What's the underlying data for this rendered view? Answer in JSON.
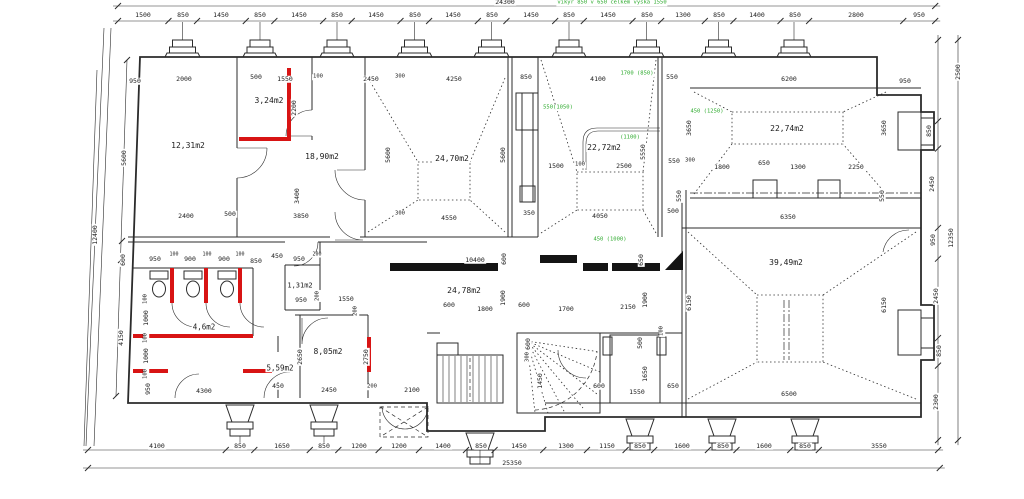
{
  "drawing_type": "floor plan",
  "colors": {
    "line": "#2b2b2b",
    "red": "#d81414",
    "green": "#2daa2d",
    "background": "#ffffff",
    "step_gray": "#c8c8c8"
  },
  "chains": [
    {
      "name": "top-total",
      "dir": "h",
      "x0": 118,
      "y": 6,
      "s": 0.03363,
      "vals": [
        24300
      ]
    },
    {
      "name": "top-detail",
      "dir": "h",
      "x0": 118,
      "y": 21,
      "s": 0.03363,
      "vals": [
        1500,
        850,
        1450,
        850,
        1450,
        850,
        1450,
        850,
        1450,
        850,
        1450,
        850,
        1450,
        850,
        1300,
        850,
        1400,
        850,
        2800,
        950
      ]
    },
    {
      "name": "bottom-detail",
      "dir": "h",
      "x0": 88,
      "y": 450,
      "s": 0.0336,
      "vals": [
        4100,
        850,
        1650,
        850,
        1200,
        1200,
        1400,
        850,
        1450,
        1300,
        1150,
        850,
        1600,
        850,
        1600,
        850,
        3550
      ]
    },
    {
      "name": "bottom-total",
      "dir": "h",
      "x0": 88,
      "y": 468,
      "s": 0.0336,
      "vals": [
        25350
      ]
    },
    {
      "name": "right-detail",
      "dir": "v",
      "x": 938,
      "y0": 40,
      "s": 0.0324,
      "vals": [
        2500,
        850,
        2450,
        950,
        2450,
        850,
        2300
      ]
    },
    {
      "name": "right-total",
      "dir": "v",
      "x": 958,
      "y0": 40,
      "s": 0.0324,
      "vals": [
        12350
      ]
    }
  ],
  "dormers": {
    "top_base": 57,
    "top": [
      [
        168,
        197
      ],
      [
        246,
        274
      ],
      [
        323,
        351
      ],
      [
        400,
        429
      ],
      [
        477,
        506
      ],
      [
        555,
        583
      ],
      [
        632,
        661
      ],
      [
        704,
        733
      ],
      [
        780,
        808
      ]
    ],
    "bottom": [
      [
        226,
        254
      ],
      [
        310,
        338
      ],
      [
        466,
        494
      ],
      [
        626,
        654
      ],
      [
        708,
        736
      ],
      [
        791,
        819
      ]
    ],
    "red_bottom_index": 0
  },
  "rooms": [
    {
      "area": "12,31m2"
    },
    {
      "area": "3,24m2"
    },
    {
      "area": "18,90m2"
    },
    {
      "area": "24,70m2"
    },
    {
      "area": "22,72m2"
    },
    {
      "area": "22,74m2"
    },
    {
      "area": "39,49m2"
    },
    {
      "area": "24,78m2"
    },
    {
      "area": "4,6m2"
    },
    {
      "area": "5,59m2"
    },
    {
      "area": "1,31m2"
    },
    {
      "area": "8,05m2"
    }
  ],
  "labels": [
    {
      "t": "24300",
      "x": 505,
      "y": 2
    },
    {
      "t": "vikyr 850 v 650 celkem vyska 1550",
      "x": 612,
      "y": 3,
      "c": "g",
      "s": 5.5
    },
    {
      "t": "1500",
      "x": 143,
      "y": 15
    },
    {
      "t": "850",
      "x": 183,
      "y": 15
    },
    {
      "t": "1450",
      "x": 221,
      "y": 15
    },
    {
      "t": "850",
      "x": 260,
      "y": 15
    },
    {
      "t": "1450",
      "x": 299,
      "y": 15
    },
    {
      "t": "850",
      "x": 337,
      "y": 15
    },
    {
      "t": "1450",
      "x": 376,
      "y": 15
    },
    {
      "t": "850",
      "x": 415,
      "y": 15
    },
    {
      "t": "1450",
      "x": 453,
      "y": 15
    },
    {
      "t": "850",
      "x": 492,
      "y": 15
    },
    {
      "t": "1450",
      "x": 531,
      "y": 15
    },
    {
      "t": "850",
      "x": 569,
      "y": 15
    },
    {
      "t": "1450",
      "x": 608,
      "y": 15
    },
    {
      "t": "850",
      "x": 647,
      "y": 15
    },
    {
      "t": "1300",
      "x": 683,
      "y": 15
    },
    {
      "t": "850",
      "x": 719,
      "y": 15
    },
    {
      "t": "1400",
      "x": 757,
      "y": 15
    },
    {
      "t": "850",
      "x": 795,
      "y": 15
    },
    {
      "t": "2800",
      "x": 856,
      "y": 15
    },
    {
      "t": "950",
      "x": 919,
      "y": 15
    },
    {
      "t": "950",
      "x": 135,
      "y": 81
    },
    {
      "t": "2000",
      "x": 184,
      "y": 79
    },
    {
      "t": "500",
      "x": 256,
      "y": 77
    },
    {
      "t": "1550",
      "x": 285,
      "y": 79
    },
    {
      "t": "100",
      "x": 318,
      "y": 77,
      "s": 5.5
    },
    {
      "t": "2450",
      "x": 371,
      "y": 79
    },
    {
      "t": "300",
      "x": 400,
      "y": 77,
      "s": 5.5
    },
    {
      "t": "4250",
      "x": 454,
      "y": 79
    },
    {
      "t": "850",
      "x": 526,
      "y": 77
    },
    {
      "t": "4100",
      "x": 598,
      "y": 79
    },
    {
      "t": "1700 (850)",
      "x": 637,
      "y": 74,
      "c": "g",
      "s": 5.5
    },
    {
      "t": "550",
      "x": 672,
      "y": 77
    },
    {
      "t": "6200",
      "x": 789,
      "y": 79
    },
    {
      "t": "950",
      "x": 905,
      "y": 81
    },
    {
      "t": "12,31m2",
      "x": 188,
      "y": 146,
      "s": 8
    },
    {
      "t": "3,24m2",
      "x": 269,
      "y": 101,
      "s": 8
    },
    {
      "t": "18,90m2",
      "x": 322,
      "y": 157,
      "s": 8
    },
    {
      "t": "24,70m2",
      "x": 452,
      "y": 159,
      "s": 8
    },
    {
      "t": "22,72m2",
      "x": 604,
      "y": 148,
      "s": 8
    },
    {
      "t": "22,74m2",
      "x": 787,
      "y": 129,
      "s": 8
    },
    {
      "t": "39,49m2",
      "x": 786,
      "y": 263,
      "s": 8
    },
    {
      "t": "24,78m2",
      "x": 464,
      "y": 291,
      "s": 8
    },
    {
      "t": "4,6m2",
      "x": 204,
      "y": 327,
      "s": 7.5
    },
    {
      "t": "5,59m2",
      "x": 280,
      "y": 368,
      "s": 7.5
    },
    {
      "t": "1,31m2",
      "x": 300,
      "y": 286,
      "s": 7
    },
    {
      "t": "8,05m2",
      "x": 328,
      "y": 352,
      "s": 8
    },
    {
      "t": "550(1050)",
      "x": 558,
      "y": 108,
      "c": "g",
      "s": 5.5
    },
    {
      "t": "450 (1250)",
      "x": 707,
      "y": 112,
      "c": "g",
      "s": 5.5
    },
    {
      "t": "(1100)",
      "x": 630,
      "y": 138,
      "c": "g",
      "s": 5.5
    },
    {
      "t": "450 (1000)",
      "x": 610,
      "y": 240,
      "c": "g",
      "s": 5.5
    },
    {
      "t": "2200",
      "x": 294,
      "y": 108,
      "r": 1
    },
    {
      "t": "5600",
      "x": 124,
      "y": 158,
      "r": 1
    },
    {
      "t": "5600",
      "x": 388,
      "y": 155,
      "r": 1
    },
    {
      "t": "5600",
      "x": 503,
      "y": 155,
      "r": 1
    },
    {
      "t": "5550",
      "x": 643,
      "y": 152,
      "r": 1
    },
    {
      "t": "3650",
      "x": 689,
      "y": 128,
      "r": 1
    },
    {
      "t": "3650",
      "x": 884,
      "y": 128,
      "r": 1
    },
    {
      "t": "3400",
      "x": 297,
      "y": 196,
      "r": 1
    },
    {
      "t": "2500",
      "x": 958,
      "y": 72,
      "r": 1
    },
    {
      "t": "850",
      "x": 929,
      "y": 131,
      "r": 1
    },
    {
      "t": "2450",
      "x": 932,
      "y": 184,
      "r": 1
    },
    {
      "t": "950",
      "x": 933,
      "y": 240,
      "r": 1
    },
    {
      "t": "12350",
      "x": 951,
      "y": 238,
      "r": 1
    },
    {
      "t": "2450",
      "x": 936,
      "y": 296,
      "r": 1
    },
    {
      "t": "850",
      "x": 939,
      "y": 351,
      "r": 1
    },
    {
      "t": "2300",
      "x": 936,
      "y": 402,
      "r": 1
    },
    {
      "t": "6150",
      "x": 689,
      "y": 303,
      "r": 1
    },
    {
      "t": "6150",
      "x": 884,
      "y": 305,
      "r": 1
    },
    {
      "t": "12400",
      "x": 95,
      "y": 235,
      "r": 1
    },
    {
      "t": "600",
      "x": 123,
      "y": 260,
      "r": 1
    },
    {
      "t": "4150",
      "x": 121,
      "y": 338,
      "r": 1
    },
    {
      "t": "550",
      "x": 679,
      "y": 196,
      "r": 1
    },
    {
      "t": "550",
      "x": 882,
      "y": 196,
      "r": 1
    },
    {
      "t": "1900",
      "x": 503,
      "y": 298,
      "r": 1
    },
    {
      "t": "1900",
      "x": 645,
      "y": 300,
      "r": 1
    },
    {
      "t": "600",
      "x": 504,
      "y": 259,
      "r": 1
    },
    {
      "t": "650",
      "x": 641,
      "y": 260,
      "r": 1
    },
    {
      "t": "600",
      "x": 528,
      "y": 344,
      "r": 1
    },
    {
      "t": "300",
      "x": 528,
      "y": 357,
      "r": 1,
      "s": 5.5
    },
    {
      "t": "1450",
      "x": 540,
      "y": 381,
      "r": 1
    },
    {
      "t": "1650",
      "x": 645,
      "y": 374,
      "r": 1
    },
    {
      "t": "500",
      "x": 640,
      "y": 343,
      "r": 1
    },
    {
      "t": "100",
      "x": 662,
      "y": 331,
      "r": 1,
      "s": 5.5
    },
    {
      "t": "2650",
      "x": 300,
      "y": 357,
      "r": 1
    },
    {
      "t": "2750",
      "x": 366,
      "y": 357,
      "r": 1
    },
    {
      "t": "200",
      "x": 356,
      "y": 311,
      "r": 1,
      "s": 5.5
    },
    {
      "t": "200",
      "x": 318,
      "y": 296,
      "r": 1,
      "s": 5.5
    },
    {
      "t": "100",
      "x": 146,
      "y": 299,
      "r": 1,
      "s": 5.5
    },
    {
      "t": "1000",
      "x": 146,
      "y": 318,
      "r": 1
    },
    {
      "t": "100",
      "x": 146,
      "y": 338,
      "r": 1,
      "s": 5.5
    },
    {
      "t": "1000",
      "x": 146,
      "y": 356,
      "r": 1
    },
    {
      "t": "100",
      "x": 146,
      "y": 374,
      "r": 1,
      "s": 5.5
    },
    {
      "t": "950",
      "x": 148,
      "y": 389,
      "r": 1
    },
    {
      "t": "1500",
      "x": 556,
      "y": 166
    },
    {
      "t": "100",
      "x": 580,
      "y": 165,
      "s": 5.5
    },
    {
      "t": "2500",
      "x": 624,
      "y": 166
    },
    {
      "t": "550",
      "x": 674,
      "y": 161
    },
    {
      "t": "300",
      "x": 690,
      "y": 161,
      "s": 5.5
    },
    {
      "t": "1800",
      "x": 722,
      "y": 167
    },
    {
      "t": "650",
      "x": 764,
      "y": 163
    },
    {
      "t": "1300",
      "x": 798,
      "y": 167
    },
    {
      "t": "2250",
      "x": 856,
      "y": 167
    },
    {
      "t": "2400",
      "x": 186,
      "y": 216
    },
    {
      "t": "500",
      "x": 230,
      "y": 214
    },
    {
      "t": "3850",
      "x": 301,
      "y": 216
    },
    {
      "t": "300",
      "x": 400,
      "y": 214,
      "s": 5.5
    },
    {
      "t": "4550",
      "x": 449,
      "y": 218
    },
    {
      "t": "350",
      "x": 529,
      "y": 213
    },
    {
      "t": "4050",
      "x": 600,
      "y": 216
    },
    {
      "t": "500",
      "x": 673,
      "y": 211
    },
    {
      "t": "6350",
      "x": 788,
      "y": 217
    },
    {
      "t": "950",
      "x": 155,
      "y": 259
    },
    {
      "t": "100",
      "x": 174,
      "y": 255,
      "s": 5
    },
    {
      "t": "900",
      "x": 190,
      "y": 259
    },
    {
      "t": "100",
      "x": 207,
      "y": 255,
      "s": 5
    },
    {
      "t": "900",
      "x": 224,
      "y": 259
    },
    {
      "t": "100",
      "x": 240,
      "y": 255,
      "s": 5
    },
    {
      "t": "850",
      "x": 256,
      "y": 261
    },
    {
      "t": "450",
      "x": 277,
      "y": 256
    },
    {
      "t": "950",
      "x": 299,
      "y": 259
    },
    {
      "t": "200",
      "x": 317,
      "y": 255,
      "s": 5
    },
    {
      "t": "10400",
      "x": 475,
      "y": 260
    },
    {
      "t": "950",
      "x": 301,
      "y": 300
    },
    {
      "t": "1550",
      "x": 346,
      "y": 299
    },
    {
      "t": "600",
      "x": 449,
      "y": 305
    },
    {
      "t": "1800",
      "x": 485,
      "y": 309
    },
    {
      "t": "600",
      "x": 524,
      "y": 305
    },
    {
      "t": "1700",
      "x": 566,
      "y": 309
    },
    {
      "t": "2150",
      "x": 628,
      "y": 307
    },
    {
      "t": "600",
      "x": 599,
      "y": 386
    },
    {
      "t": "1550",
      "x": 637,
      "y": 392
    },
    {
      "t": "650",
      "x": 673,
      "y": 386
    },
    {
      "t": "2450",
      "x": 329,
      "y": 390
    },
    {
      "t": "200",
      "x": 372,
      "y": 387,
      "s": 5.5
    },
    {
      "t": "2100",
      "x": 412,
      "y": 390
    },
    {
      "t": "4300",
      "x": 204,
      "y": 391
    },
    {
      "t": "450",
      "x": 278,
      "y": 386
    },
    {
      "t": "6500",
      "x": 789,
      "y": 394
    },
    {
      "t": "4100",
      "x": 157,
      "y": 446
    },
    {
      "t": "850",
      "x": 240,
      "y": 446
    },
    {
      "t": "1650",
      "x": 282,
      "y": 446
    },
    {
      "t": "850",
      "x": 324,
      "y": 446
    },
    {
      "t": "1200",
      "x": 359,
      "y": 446
    },
    {
      "t": "1200",
      "x": 399,
      "y": 446
    },
    {
      "t": "1400",
      "x": 443,
      "y": 446
    },
    {
      "t": "850",
      "x": 481,
      "y": 446
    },
    {
      "t": "1450",
      "x": 519,
      "y": 446
    },
    {
      "t": "1300",
      "x": 566,
      "y": 446
    },
    {
      "t": "1150",
      "x": 607,
      "y": 446
    },
    {
      "t": "850",
      "x": 640,
      "y": 446
    },
    {
      "t": "1600",
      "x": 682,
      "y": 446
    },
    {
      "t": "850",
      "x": 723,
      "y": 446
    },
    {
      "t": "1600",
      "x": 764,
      "y": 446
    },
    {
      "t": "850",
      "x": 805,
      "y": 446
    },
    {
      "t": "3550",
      "x": 879,
      "y": 446
    },
    {
      "t": "25350",
      "x": 512,
      "y": 463
    }
  ]
}
